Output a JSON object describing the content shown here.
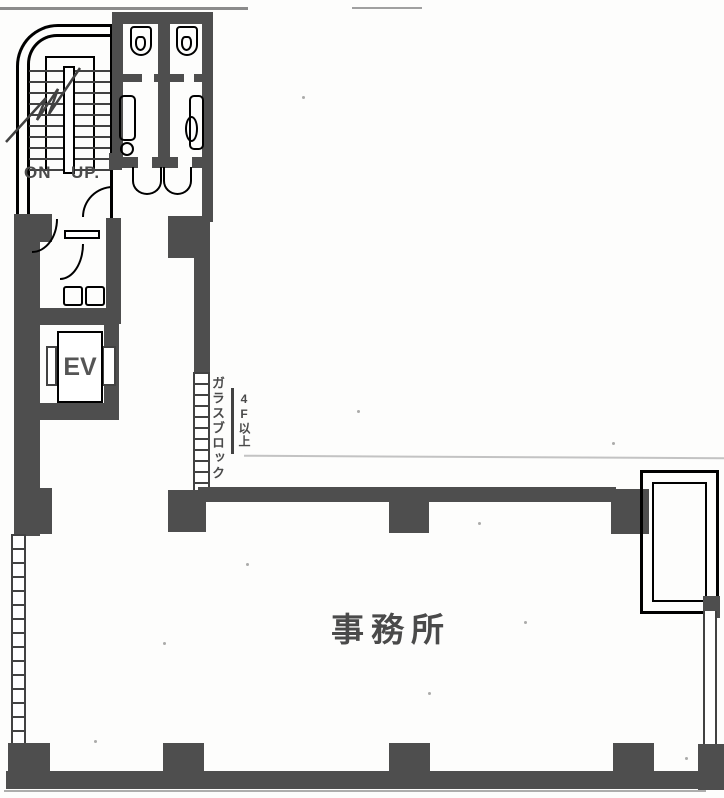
{
  "meta": {
    "description": "Scanned Japanese architectural floor plan, office floor with stairs, toilets and elevator",
    "colors": {
      "wall": "#4e4e4e",
      "line": "#424242",
      "faint": "#a5a5a5",
      "paper": "#fdfdfc",
      "text": "#4a4a4a"
    },
    "icons": {
      "urinal": "css-outline-shape",
      "toilet": "css-outline-shape",
      "sink-counter": "css-outline-square",
      "door-swing": "css-quarter-arc",
      "elevator-car": "css-outline-rect"
    }
  },
  "plan": {
    "stairs": {
      "label_on": "ON",
      "label_up": "UP."
    },
    "elevator": {
      "label": "EV"
    },
    "office": {
      "label": "事務所"
    },
    "glass_block": {
      "label": "ガラスブロック",
      "note": "4F以上"
    }
  }
}
